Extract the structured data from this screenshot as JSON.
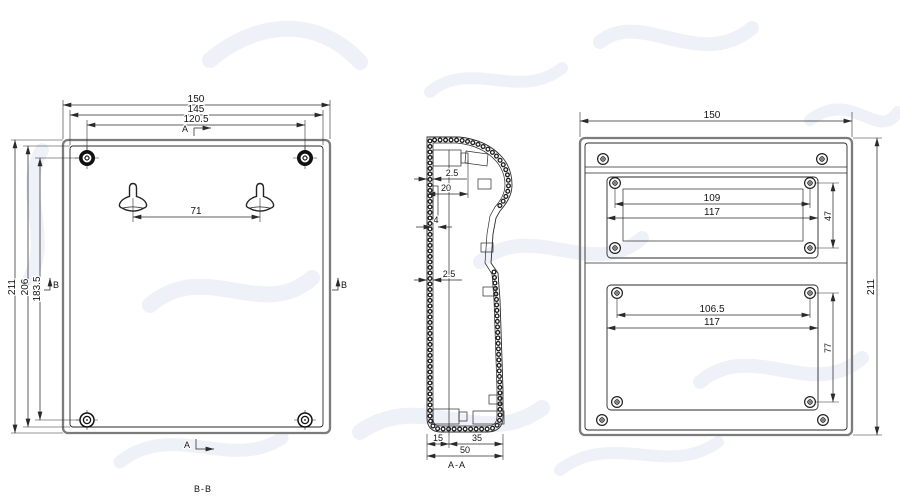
{
  "colors": {
    "line": "#2a2a2a",
    "frame": "#7c7c7c",
    "background": "#ffffff",
    "watermark": "#eef1f7"
  },
  "front_view": {
    "section_label": "B-B",
    "dims": {
      "overall_width": "150",
      "inner_width": "145",
      "screw_span_h": "120.5",
      "keyhole_span": "71",
      "overall_height": "211",
      "inner_height": "206",
      "screw_span_v": "183.5"
    },
    "markers": {
      "a": "A",
      "b": "B"
    }
  },
  "side_view": {
    "section_label": "A-A",
    "dims": {
      "wall_top": "2.5",
      "boss_depth": "20",
      "rib": "4",
      "wall_mid": "2.5",
      "bottom_left": "15",
      "bottom_right": "35",
      "overall_depth": "50"
    }
  },
  "back_view": {
    "dims": {
      "overall_width": "150",
      "overall_height": "211",
      "upper_screw_span": "109",
      "upper_width": "117",
      "upper_height": "47",
      "lower_screw_span": "106.5",
      "lower_width": "117",
      "lower_height": "77"
    }
  }
}
